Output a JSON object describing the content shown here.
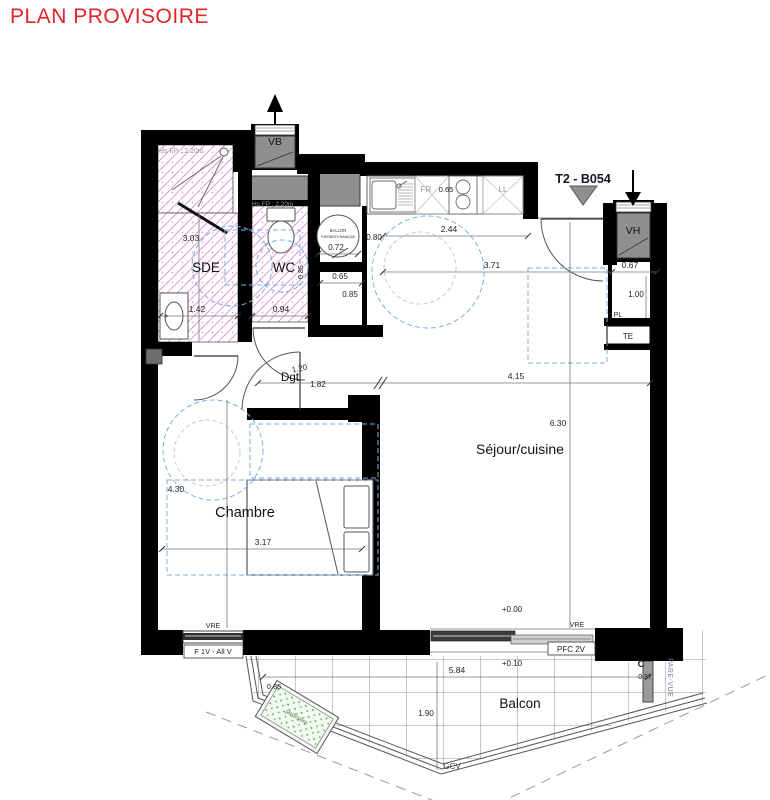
{
  "title": "PLAN PROVISOIRE",
  "unit_code": "T2 - B054",
  "rooms": {
    "sde": "SDE",
    "wc": "WC",
    "dgt": "Dgt",
    "sejour": "Séjour/cuisine",
    "chambre": "Chambre",
    "balcon": "Balcon"
  },
  "vents": {
    "vb": "VB",
    "vh": "VH"
  },
  "equip": {
    "ballon_l1": "BALLON",
    "ballon_l2": "THERMODYNAMIQUE",
    "fr": "FR",
    "ll": "LL",
    "pl": "PL",
    "te": "TE",
    "hs_shower": "Hs FP : 2.20m",
    "hs_wc": "Hs FP : 2.20m",
    "vre_chambre": "VRE",
    "vre_sejour": "VRE",
    "f1v": "F 1V - All V",
    "pfc": "PFC 2V",
    "gcv": "GCV",
    "pare_vue": "PARE-VUE",
    "jardiniere": "jardinière",
    "c_marker": "C"
  },
  "levels": {
    "sejour": "+0.00",
    "balcon": "+0.10"
  },
  "dims": {
    "sde_h": "3.03",
    "sde_w": "1.42",
    "wc_w": "0.94",
    "wc_side": "0.85",
    "kitchen_w": "2.44",
    "kitchen_d": "0.65",
    "closet_w": "0.80",
    "ballon_d": "0.72",
    "niche_w": "0.65",
    "niche_h": "0.85",
    "entry_w": "3.71",
    "pl_w": "0.67",
    "pl_h": "1.00",
    "dgt_w": "1.20",
    "dgt_l": "1.82",
    "sejour_w": "4.15",
    "sejour_h": "6.30",
    "chambre_h": "4.30",
    "chambre_w": "3.17",
    "balcon_w": "5.84",
    "balcon_d": "1.90",
    "jardiniere_l": "0.85",
    "pare_vue_w": "0.37"
  },
  "colors": {
    "title": "#e5242a",
    "wall": "#000000",
    "hatch": "#dd8ad2",
    "dashed_blue": "#7aaede",
    "gray_fill": "#8f8f8f",
    "green": "#3f9e3f",
    "grid": "#b8b8b8"
  }
}
